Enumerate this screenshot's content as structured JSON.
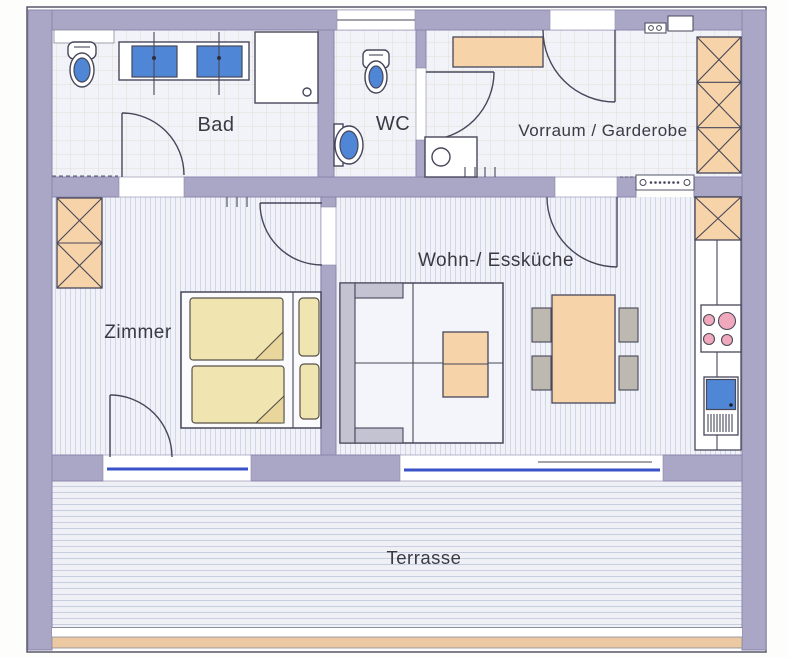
{
  "rooms": {
    "bad": {
      "label": "Bad"
    },
    "wc": {
      "label": "WC"
    },
    "vorraum": {
      "label": "Vorraum / Garderobe"
    },
    "zimmer": {
      "label": "Zimmer"
    },
    "wohnkueche": {
      "label": "Wohn-/ Essküche"
    },
    "terrasse": {
      "label": "Terrasse"
    }
  },
  "colors": {
    "wall": "#a9a6c6",
    "wall_edge": "#8b87ae",
    "furniture_wood": "#f6d3a8",
    "bedding": "#f0e4b0",
    "water": "#4f86d6",
    "burner": "#f0a8bc",
    "line": "#47475a"
  }
}
